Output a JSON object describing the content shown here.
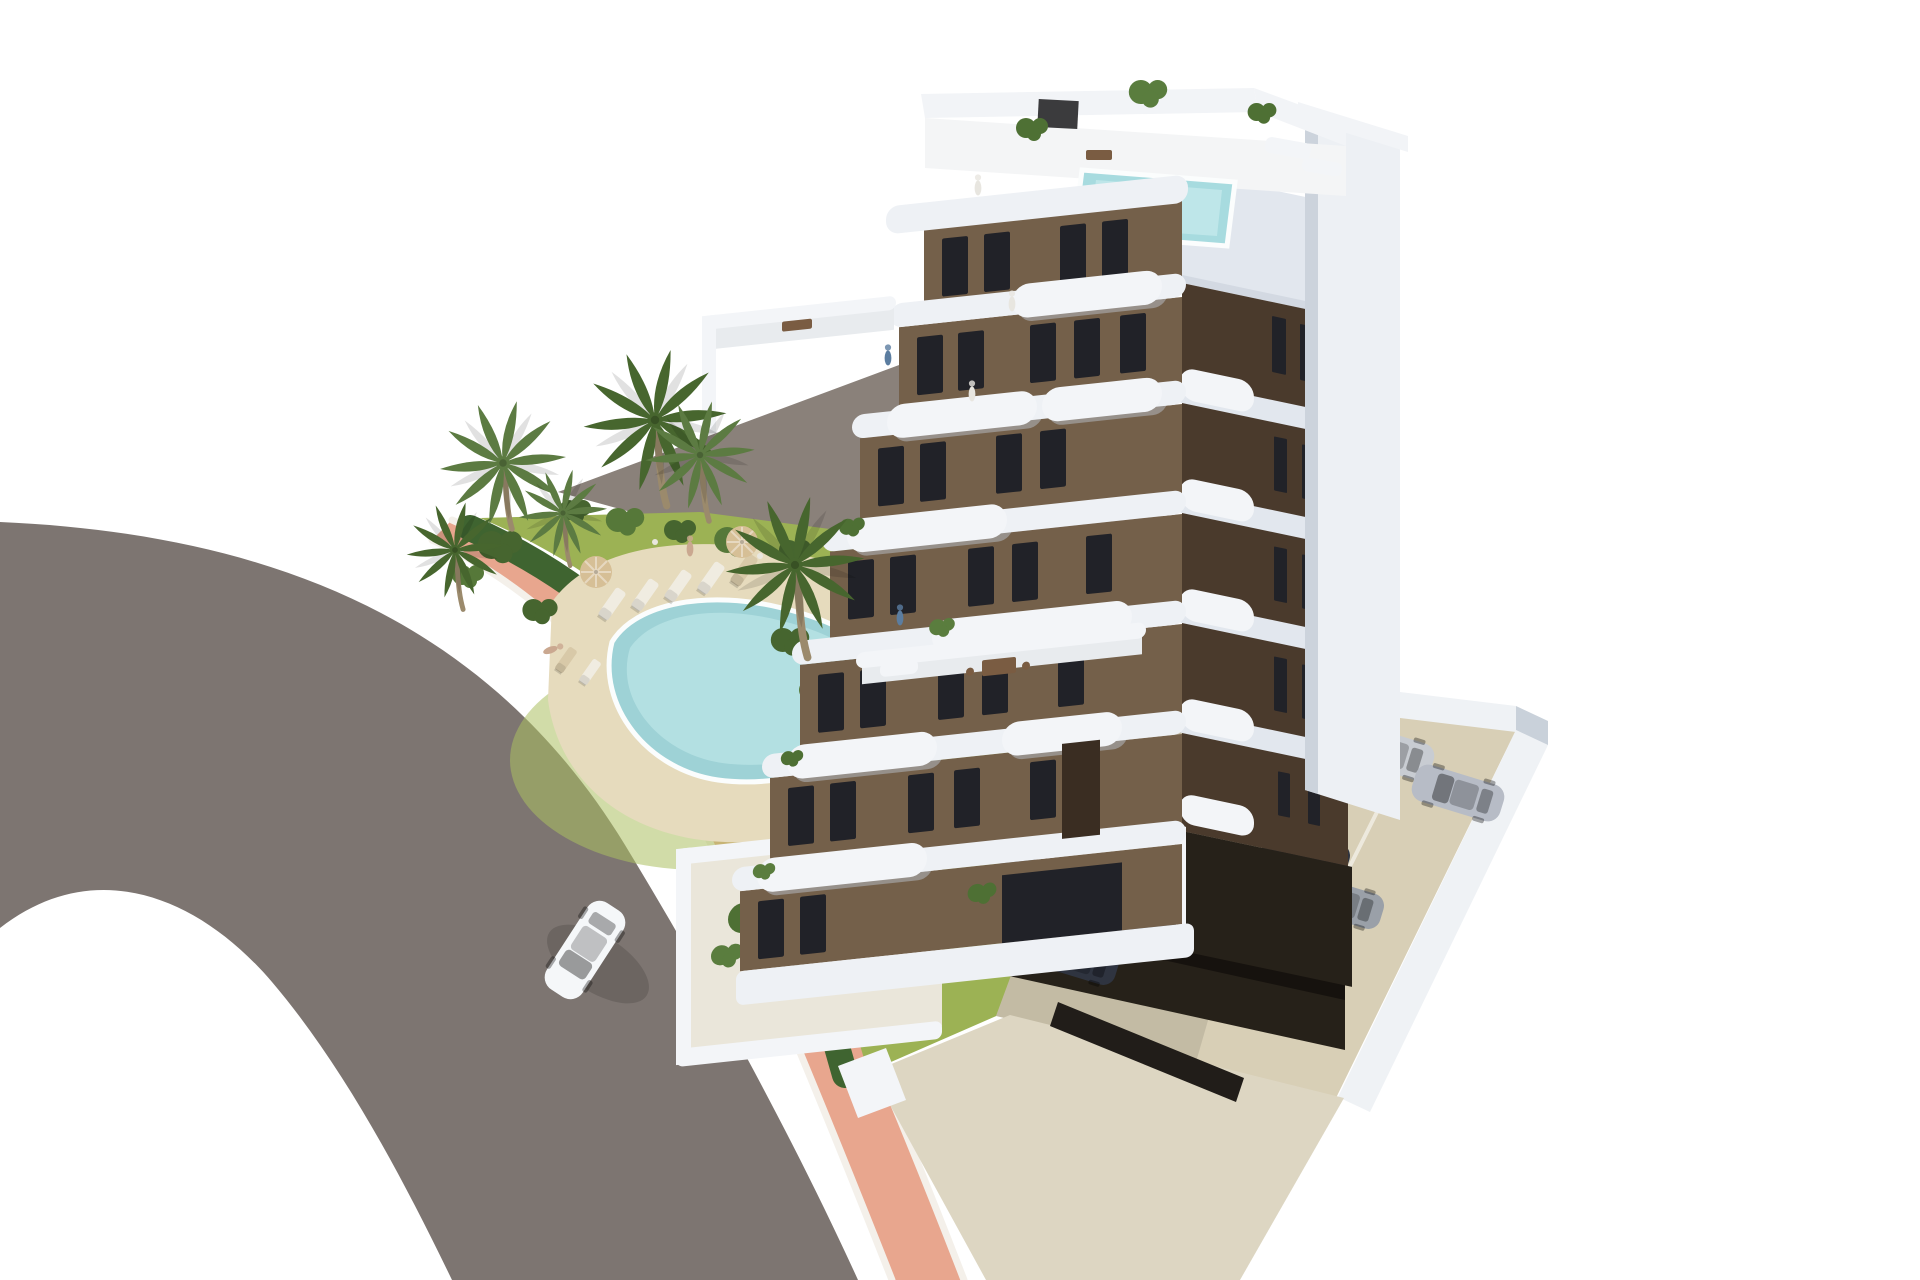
{
  "scene": {
    "type": "architectural-3d-render",
    "subject": "aerial view of a modern white-and-brown apartment block with rooftop pool, landscaped garden pool, palm trees, curved road and private parking",
    "counts": {
      "building_floors": 8,
      "palm_trees": 6,
      "garden_sun_loungers": 7,
      "parasols": 2,
      "covered_parking_cars": 5,
      "open_parking_cars": 2,
      "cars_on_road": 1,
      "people_visible": 7
    }
  },
  "colors": {
    "bg": "#ffffff",
    "pavement": "#8a817a",
    "road": "#7d7571",
    "sidewalk": "#e8a68e",
    "curb": "#f4f0ea",
    "hedge": "#3f6430",
    "lawn": "#9cb254",
    "lawn_light": "#abc061",
    "sand": "#e6dbbd",
    "pool": "#9ed2d6",
    "pool_light": "#bce5e7",
    "pool_rim": "#fbfdfd",
    "bush_dark": "#46652f",
    "bush_mid": "#567839",
    "stone": "#e9e7df",
    "palm_frond": "#5c7b42",
    "palm_frond_dark": "#47662e",
    "palm_trunk": "#9b8a6c",
    "slab": "#eef1f5",
    "slab_shade": "#c9d1da",
    "wall_white": "#f3f5f8",
    "wall_white_dim": "#e2e7ee",
    "facade_brown": "#74604a",
    "facade_brown_dark": "#4a3a2c",
    "window_dark": "#212228",
    "balcony_shadow": "#b9c0ca",
    "terrace_floor": "#e8ebee",
    "column_white": "#edf0f4",
    "column_shade": "#ccd3dc",
    "roof_white": "#f2f4f7",
    "roof_floor": "#f4f5f6",
    "rooftop_pool": "#a7dbdf",
    "rooftop_pool_light": "#c6eaec",
    "ac_unit": "#3b3b3d",
    "garage_dark": "#262119",
    "garage_deep": "#16120e",
    "entry_dark": "#211d19",
    "patio_floor": "#eae6da",
    "walkway": "#ddd6c2",
    "parking_ground": "#d8cfb6",
    "wall_light": "#eff2f5",
    "plant_green": "#4e7034",
    "plant_light": "#5a7d3e",
    "furniture_brown": "#7a5c42",
    "furniture_dark": "#3a2d22",
    "lounger_white": "#f0ece1",
    "lounger_wood": "#d8c9a8",
    "umbrella": "#d6bf96",
    "car_white": "#f5f7f9",
    "car_silver": "#c8ccd2",
    "car_silver2": "#b7bcc6",
    "car_silver3": "#9aa0a8",
    "car_dark1": "#2f3440",
    "car_dark2": "#3a4150",
    "car_dark3": "#2c313b",
    "person_blue": "#5b7da0",
    "person_light": "#e8e6e0",
    "person_tan": "#caa890"
  }
}
